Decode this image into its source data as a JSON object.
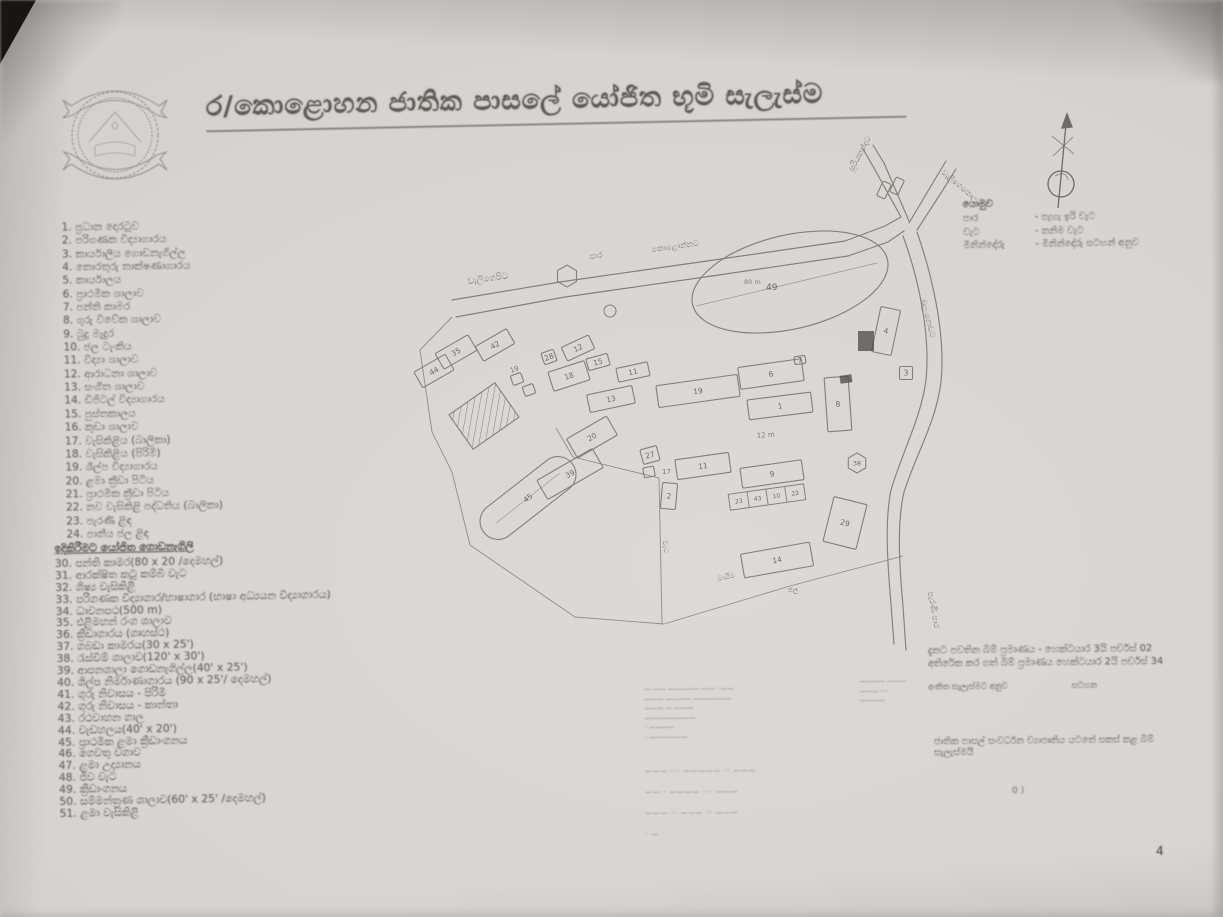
{
  "page": {
    "title": "ර/කොළොහන ජාතික පාසලේ යෝජිත භූමි සැලැස්ම",
    "page_number": "4"
  },
  "legend_primary": {
    "items": [
      "1. ප්‍රධාන දොරටුව",
      "2. පරිගණක විද්‍යාගාරය",
      "3. කාර්යාලීය ගොඩනැගිල්ල",
      "4. තොරතුරු තාක්ෂණාගාරය",
      "5. කාර්යාලය",
      "6. ප්‍රාථමික ශාලාව",
      "7. පන්ති කාමර",
      "8. ගුරු විවේක ශාලාව",
      "9. බුදු මැදුර",
      "10. ජල ටැංකිය",
      "11. විද්‍යා ශාලාව",
      "12. ආරාධනා ශාලාව",
      "13. සංගීත ශාලාව",
      "14. ඩිජිටල් විද්‍යාගාරය",
      "15. පුස්තකාලය",
      "16. කුඩා ශාලාව",
      "17. වැසිකිළිය (බාලිකා)",
      "18. වැසිකිළිය (පිරිමි)",
      "19. ශිල්ප විද්‍යාගාරය",
      "20. ළමා ක්‍රීඩා පිටිය",
      "21. ප්‍රාථමික ක්‍රීඩා පිටිය",
      "22. නව වැසිකිළි පද්ධතිය (බාලිකා)",
      "23. පැරණි ළිඳ",
      "24. පානීය ජල ළිඳ"
    ]
  },
  "legend_proposed": {
    "header": "ඉදිකිරීමට යෝජිත ගොඩනැගිලි",
    "items": [
      "30. පන්ති කාමර(80 x 20 /දෙමහල්)",
      "31. ආරක්ෂිත කටු කම්බි වැට",
      "32. ශිෂ්‍ය වැසිකිළි",
      "33. පරිගණක විද්‍යාගාර/භාෂාගාර (භාෂා අධ්‍යයන විද්‍යාගාරය)",
      "34. ධාවනපථ(500 m)",
      "35. එළිමහන් රංග ශාලාව",
      "36. ක්‍රීඩාගාරය (ගෘහස්ථ)",
      "37. ගබඩා කාමරය(30 x 25')",
      "38. රැස්වීම් ශාලාව(120' x 30')",
      "39. ආපනශාලා ගොඩනැගිල්ල(40' x 25')",
      "40. ශිල්ප නිර්මාණාගාරය (90 x 25'/ දෙමහල්)",
      "41. ගුරු නිවාසය - පිරිමි",
      "42. ගුරු නිවාසය - කාන්තා",
      "43. රථවාහන ගාල",
      "44. වැඩහලය(40' x 20')",
      "45. ප්‍රාථමික ළමා ක්‍රීඩාංගනය",
      "46. ගෙවතු වගාව",
      "47. ළමා උද්‍යානය",
      "48. ජීව වැට",
      "49. ක්‍රීඩාංගනය",
      "50. සම්මන්ත්‍රණ ශාලාව(60' x 25' /දෙමහල්)",
      "51. ළමා වැසිකිළි"
    ]
  },
  "key": {
    "header": "යොමුව",
    "rows": [
      {
        "term": "පාර",
        "desc": "- පැහැ ඉරි වැට"
      },
      {
        "term": "වැට",
        "desc": "- තනිම වැට"
      },
      {
        "term": "මිනින්දෝරු",
        "desc": "- මිනින්දෝරු සටහන් අනුව"
      }
    ]
  },
  "notes": {
    "line1": "දැනට පවතින බිම් ප්‍රමාණය - හෙක්ටයාර 3යි පර්චස් 02",
    "line2": "අතිරේක කර ගත් බිම් ප්‍රමාණය හෙක්ටයාර 2යි පර්චස් 34",
    "line3a": "අංකිත සැලැස්මට අනුව",
    "line3b": "සටහන",
    "line4": "ජාතික පාසල් සංවර්ධන ව්‍යාපෘතිය යටතේ සකස් කළ බිම් සැලැස්මයි",
    "stray_mark": "0 )"
  },
  "stamp": {
    "left_lines": [
      "— —— ————— —— · ——",
      "——— ———— ——————",
      "——— — ———",
      "————————",
      "· ————",
      "- ——————"
    ],
    "right_lines": [
      "———— ———",
      "——— ····",
      "————"
    ],
    "table_rows": [
      "——— ···  ————— ·· ———",
      "—— ·  ———— ··· ———",
      "——— ··  ——— ·· ———",
      "· —"
    ]
  },
  "map": {
    "roads": [
      "M452,300 L560,282 L700,262 L845,241",
      "M456,317 L565,297 L705,277 L848,256",
      "M845,241 L885,226 L901,217",
      "M848,256 L888,242 L904,231",
      "M901,217 L874,168 L863,149",
      "M909,221 L884,163 L873,145",
      "M909,223 L931,186 L946,161",
      "M917,230 L941,193 L956,169",
      "M917,232 C931,272 946,332 941,382 C936,422 917,452 904,492 C897,522 899,562 903,606 L906,650",
      "M903,236 C917,274 931,332 926,380 C921,418 903,450 891,490 C885,520 887,558 891,604 L894,644"
    ],
    "boundaries": [
      "M452,317 L420,350 L432,432 L452,472 L470,545",
      "M470,545 L575,617 L664,624",
      "M664,624 L790,586 L903,556",
      "M659,478 L662,624",
      "M556,428 L573,457 L659,478"
    ],
    "buildings": [
      {
        "label": "44",
        "x": 434,
        "y": 371,
        "w": 36,
        "h": 18,
        "r": -30
      },
      {
        "label": "35",
        "x": 456,
        "y": 352,
        "w": 38,
        "h": 18,
        "r": -30
      },
      {
        "label": "42",
        "x": 495,
        "y": 345,
        "w": 36,
        "h": 17,
        "r": -30
      },
      {
        "label": "28",
        "x": 549,
        "y": 357,
        "w": 13,
        "h": 12,
        "r": -20
      },
      {
        "label": "12",
        "x": 578,
        "y": 348,
        "w": 30,
        "h": 15,
        "r": -25
      },
      {
        "label": "18",
        "x": 569,
        "y": 376,
        "w": 38,
        "h": 20,
        "r": -18
      },
      {
        "label": "15",
        "x": 598,
        "y": 362,
        "w": 22,
        "h": 12,
        "r": -15
      },
      {
        "label": "11",
        "x": 633,
        "y": 372,
        "w": 32,
        "h": 14,
        "r": -12
      },
      {
        "label": "13",
        "x": 611,
        "y": 399,
        "w": 46,
        "h": 18,
        "r": -12
      },
      {
        "label": "",
        "x": 517,
        "y": 379,
        "w": 11,
        "h": 10,
        "r": -20
      },
      {
        "label": "",
        "x": 529,
        "y": 390,
        "w": 11,
        "h": 10,
        "r": -20
      },
      {
        "label": "19",
        "x": 698,
        "y": 391,
        "w": 82,
        "h": 22,
        "r": -8
      },
      {
        "label": "6",
        "x": 771,
        "y": 374,
        "w": 64,
        "h": 22,
        "r": -8
      },
      {
        "label": "7",
        "x": 800,
        "y": 360,
        "w": 11,
        "h": 8,
        "r": -8
      },
      {
        "label": "1",
        "x": 780,
        "y": 406,
        "w": 64,
        "h": 20,
        "r": -7
      },
      {
        "label": "8",
        "x": 838,
        "y": 404,
        "w": 24,
        "h": 54,
        "r": -4
      },
      {
        "label": "4",
        "x": 886,
        "y": 331,
        "w": 20,
        "h": 46,
        "r": 12
      },
      {
        "label": "3",
        "x": 906,
        "y": 373,
        "w": 13,
        "h": 13,
        "r": 0
      },
      {
        "label": "",
        "x": 884,
        "y": 190,
        "w": 9,
        "h": 16,
        "r": 25
      },
      {
        "label": "",
        "x": 897,
        "y": 186,
        "w": 9,
        "h": 16,
        "r": 25
      },
      {
        "label": "20",
        "x": 592,
        "y": 437,
        "w": 46,
        "h": 22,
        "r": -30
      },
      {
        "label": "27",
        "x": 650,
        "y": 455,
        "w": 17,
        "h": 15,
        "r": -15
      },
      {
        "label": "",
        "x": 649,
        "y": 472,
        "w": 11,
        "h": 10,
        "r": -10
      },
      {
        "label": "2",
        "x": 669,
        "y": 496,
        "w": 15,
        "h": 26,
        "r": 5
      },
      {
        "label": "39",
        "x": 570,
        "y": 474,
        "w": 64,
        "h": 22,
        "r": -30
      },
      {
        "label": "11",
        "x": 703,
        "y": 466,
        "w": 54,
        "h": 20,
        "r": -8
      },
      {
        "label": "9",
        "x": 772,
        "y": 474,
        "w": 62,
        "h": 20,
        "r": -8
      },
      {
        "label": "29",
        "x": 845,
        "y": 523,
        "w": 34,
        "h": 46,
        "r": 14
      },
      {
        "label": "14",
        "x": 777,
        "y": 560,
        "w": 70,
        "h": 24,
        "r": -10
      }
    ],
    "strip": {
      "x": 767,
      "y": 497,
      "w": 76,
      "h": 16,
      "r": -8,
      "cells": [
        "23",
        "43",
        "10",
        "22"
      ]
    },
    "oval": {
      "x": 790,
      "y": 282,
      "rx": 100,
      "ry": 47,
      "r": -13,
      "label": "49",
      "area_text": "80 m",
      "chord": "M696,306 L877,263"
    },
    "stadium": {
      "x": 528,
      "y": 498,
      "w": 112,
      "h": 36,
      "r": -38,
      "label": "45"
    },
    "hatched": {
      "x": 484,
      "y": 416,
      "w": 56,
      "h": 42,
      "r": -35
    },
    "hexes": [
      {
        "x": 567,
        "y": 276,
        "rad": 11,
        "label": ""
      },
      {
        "x": 857,
        "y": 463,
        "rad": 10,
        "label": "38"
      }
    ],
    "circle": {
      "x": 610,
      "y": 311,
      "rad": 6
    },
    "dark_rects": [
      {
        "x": 846,
        "y": 379,
        "w": 12,
        "h": 8,
        "r": -8
      },
      {
        "x": 866,
        "y": 341,
        "w": 16,
        "h": 20,
        "r": 0
      }
    ],
    "labels": [
      {
        "t": "වැලිගෙපිට",
        "x": 468,
        "y": 284,
        "r": -8,
        "fs": 9
      },
      {
        "t": "පාර",
        "x": 590,
        "y": 259,
        "r": -8,
        "fs": 8
      },
      {
        "t": "කොළොන්නට",
        "x": 652,
        "y": 252,
        "r": -8,
        "fs": 8
      },
      {
        "t": "සූරියකන්දට",
        "x": 853,
        "y": 172,
        "r": -62,
        "fs": 8
      },
      {
        "t": "වැලිගෙපොලට",
        "x": 941,
        "y": 173,
        "r": 40,
        "fs": 8
      },
      {
        "t": "බලංගොඩට",
        "x": 921,
        "y": 300,
        "r": 76,
        "fs": 8
      },
      {
        "t": "පැරණි පාර",
        "x": 928,
        "y": 592,
        "r": 80,
        "fs": 8
      },
      {
        "t": "වැට",
        "x": 663,
        "y": 541,
        "r": 85,
        "fs": 7
      },
      {
        "t": "මායිම",
        "x": 718,
        "y": 581,
        "r": -12,
        "fs": 7
      },
      {
        "t": "12 m",
        "x": 757,
        "y": 438,
        "r": -5,
        "fs": 7
      },
      {
        "t": "19",
        "x": 511,
        "y": 373,
        "r": -20,
        "fs": 7
      },
      {
        "t": "17",
        "x": 662,
        "y": 474,
        "r": 0,
        "fs": 7
      },
      {
        "t": "ජල",
        "x": 788,
        "y": 592,
        "r": 0,
        "fs": 7
      }
    ],
    "line_color": "#867f78",
    "text_color": "#6f6b64"
  }
}
